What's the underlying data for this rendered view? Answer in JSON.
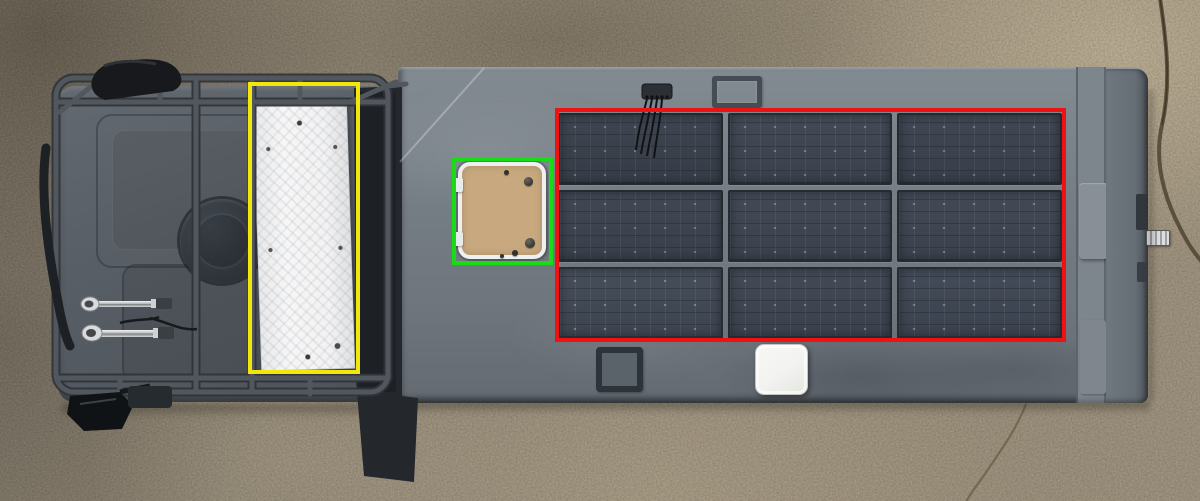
{
  "scene": {
    "type": "aerial-drone-photo",
    "subject": "expedition truck with box camper, viewed top-down",
    "setting": "concrete pad",
    "vehicle_parts": [
      "truck cab roof with tubular roof rack",
      "black duffel bag on rack front corner",
      "roof-mounted round cylinder",
      "two chrome air horns",
      "side mirror",
      "white diamond-plate panel stowed on rack",
      "black stowed panel beside white panel",
      "camper roof",
      "cable gland with wires",
      "roof mount frame",
      "tan roof access hatch with white frame",
      "3x3 solar panel array",
      "roof hatch frame",
      "white roof vent",
      "rear rail and latch"
    ]
  },
  "annotations": [
    {
      "id": "yellow-box",
      "label": "white tread panel on roof rack",
      "color": "#f2e70c",
      "box": {
        "x": 248,
        "y": 82,
        "w": 112,
        "h": 292
      }
    },
    {
      "id": "green-box",
      "label": "tan roof access hatch",
      "color": "#18dc18",
      "box": {
        "x": 452,
        "y": 157,
        "w": 101,
        "h": 108
      }
    },
    {
      "id": "red-box",
      "label": "3x3 rooftop solar panel array",
      "color": "#ee1212",
      "box": {
        "x": 555,
        "y": 108,
        "w": 511,
        "h": 234
      }
    }
  ],
  "solar_array": {
    "rows": 3,
    "cols": 3,
    "x": 558,
    "y": 113,
    "w": 504,
    "h": 226,
    "gap": 5
  },
  "palette": {
    "ground-base": "#9a8d79",
    "cab-roof": "#585e65",
    "camper-roof": "#757d85",
    "camper-edge": "#636a72",
    "solar-panel": "#3d4450",
    "solar-frame": "#262b32",
    "white-panel": "#f3f3f4",
    "hatch-tan": "#c8a87e",
    "hatch-frame": "#edeff0",
    "vent-white": "#f2f3f0"
  }
}
